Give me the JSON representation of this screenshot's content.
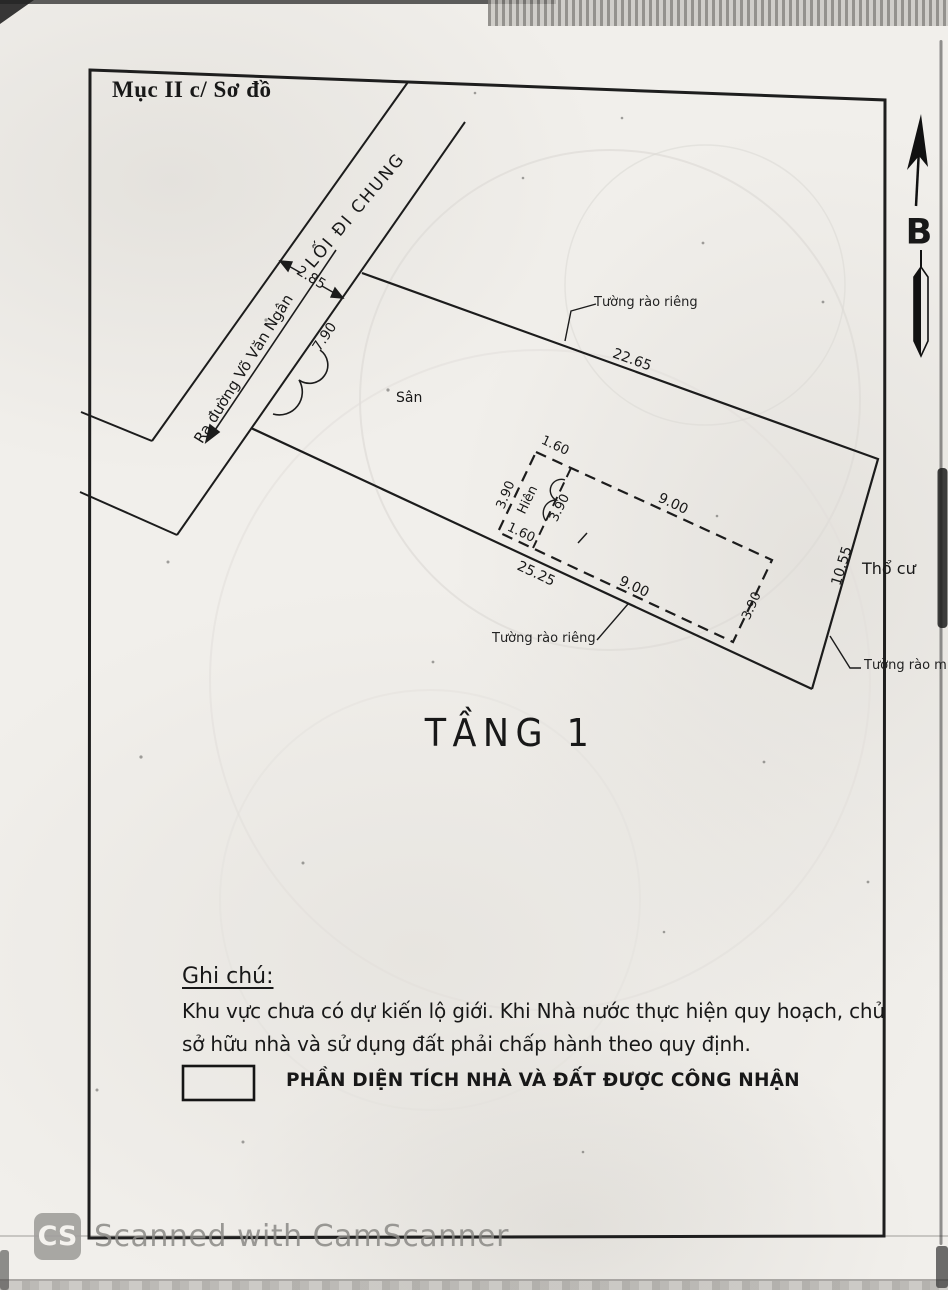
{
  "page": {
    "section_title": "Mục II c/ Sơ đồ",
    "floor_label": "TẦNG 1",
    "compass_label": "B",
    "labels": {
      "path": "LỐI ĐI CHUNG",
      "road_arrow": "Ra đường Võ Văn Ngân",
      "yard": "Sân",
      "porch": "Hiên",
      "residential": "Thổ cư",
      "fence_top": "Tường rào riêng",
      "fence_bottom": "Tường rào riêng",
      "fence_right": "Tường rào mượn"
    },
    "dims": {
      "path_width": "2.85",
      "frontage": "7.90",
      "top_edge": "22.65",
      "bottom_edge": "25.25",
      "right_edge": "10.55",
      "house_top": "9.00",
      "house_bottom": "9.00",
      "house_depth": "3.90",
      "porch_top": "1.60",
      "porch_bottom": "1.60",
      "porch_side": "3.90",
      "porch_inner": "3.90"
    },
    "notes": {
      "heading": "Ghi chú:",
      "line1": "Khu vực chưa có dự kiến lộ giới. Khi Nhà nước thực hiện quy hoạch, chủ",
      "line2": "sở hữu nhà và sử dụng đất phải chấp hành theo quy định.",
      "legend": "PHẦN DIỆN TÍCH NHÀ VÀ ĐẤT ĐƯỢC CÔNG NHẬN"
    },
    "watermark": {
      "logo": "CS",
      "text": "Scanned with CamScanner"
    },
    "colors": {
      "ink": "#1c1c1c",
      "paper": "#f1efeb",
      "watermark": "#8a8885"
    }
  }
}
